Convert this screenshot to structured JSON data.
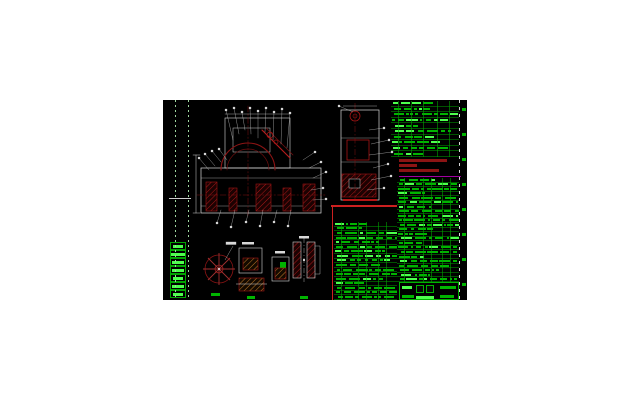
{
  "app": {
    "type": "cad-drawing-viewer",
    "description": "AutoCAD-style mechanical assembly drawing sheet: red/white linework views with white balloon callouts, green parts-list and title tables (text not legible at this resolution)"
  },
  "canvas": {
    "x": 163,
    "y": 100,
    "width": 304,
    "height": 200,
    "background": "#000000",
    "page_background": "#ffffff"
  },
  "colors": {
    "table_green": "#00b400",
    "bright_green": "#4dff4d",
    "grid_green": "#008c00",
    "drawing_red_dark": "#7a0e0e",
    "drawing_red_bright": "#cc2020",
    "hatch_orange": "#c07a28",
    "line_white": "#e8e8e8",
    "notes_red": "#8b1414",
    "magenta_rule": "#a000a0"
  },
  "tables": {
    "title_table": {
      "x": 228,
      "y": 1,
      "w": 68,
      "h": 56,
      "rows": 10,
      "chips": 6,
      "seed": 11,
      "vlines": [
        7,
        20,
        32,
        46,
        58
      ],
      "bright_ratio": 0.22
    },
    "right_parts_table": {
      "x": 234,
      "y": 78,
      "w": 62,
      "h": 104,
      "rows": 23,
      "chips": 7,
      "seed": 23,
      "vlines": [
        7,
        26,
        34,
        45,
        53
      ],
      "bright_ratio": 0.12
    },
    "bottom_parts_table": {
      "x": 171,
      "y": 122,
      "w": 63,
      "h": 78,
      "rows": 17,
      "chips": 7,
      "seed": 37,
      "vlines": [
        7,
        24,
        32,
        44,
        52
      ],
      "bright_ratio": 0.12
    }
  },
  "notes_block": {
    "x": 236,
    "y": 59,
    "w": 58,
    "h": 16,
    "line_widths": [
      48,
      18,
      40
    ],
    "color": "#8b1414"
  },
  "frame": {
    "ruler_x": 296,
    "tick_x": 299,
    "tick_count": 8,
    "tick_step": 25,
    "tick_y0": 8,
    "left_dot_lines_x": [
      12,
      25
    ],
    "mid_tick_y": 98
  },
  "revision_strip": {
    "x": 7,
    "y": 142,
    "w": 16,
    "cell_h": 8,
    "cell_count": 7,
    "seed": 51
  },
  "title_block": {
    "x": 236,
    "y": 182,
    "w": 60,
    "h": 18,
    "dark_cells": 2
  },
  "detail_labels": [
    {
      "x": 48,
      "y": 193,
      "w": 9,
      "h": 3
    },
    {
      "x": 84,
      "y": 196,
      "w": 8,
      "h": 3
    },
    {
      "x": 117,
      "y": 162,
      "w": 6,
      "h": 8
    },
    {
      "x": 137,
      "y": 196,
      "w": 8,
      "h": 3
    }
  ],
  "views": {
    "main_assembly": {
      "label": "main-assembly-front-view"
    },
    "side_view": {
      "label": "assembly-side-view"
    },
    "details": [
      "handwheel-detail",
      "hatched-part-detail-1",
      "hatched-part-detail-2",
      "twin-column-section-detail"
    ]
  }
}
